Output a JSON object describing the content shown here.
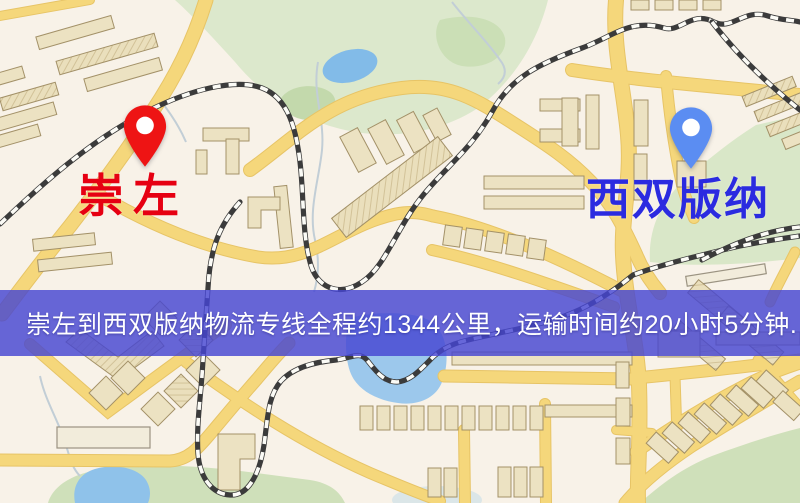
{
  "route_map": {
    "origin": {
      "label": "崇左",
      "label_color": "#e60012",
      "pin_color": "#ee1414",
      "pin_style": "red-map-pin"
    },
    "destination": {
      "label": "西双版纳",
      "label_color": "#2b2be0",
      "pin_color": "#5b8df2",
      "pin_style": "blue-map-pin"
    },
    "banner": {
      "text": "崇左到西双版纳物流专线全程约1344公里，运输时间约20小时5分钟.",
      "distance_km": "1344",
      "duration": "20小时5分钟",
      "bg_color": "rgba(70,70,210,0.82)",
      "text_color": "#ffffff"
    },
    "map_colors": {
      "background": "#f8f2e8",
      "road": "#f5d77b",
      "park": "#dce8cc",
      "water": "#8fc2ea",
      "building": "#ece2c2",
      "railway": "#3b3b3b"
    }
  }
}
